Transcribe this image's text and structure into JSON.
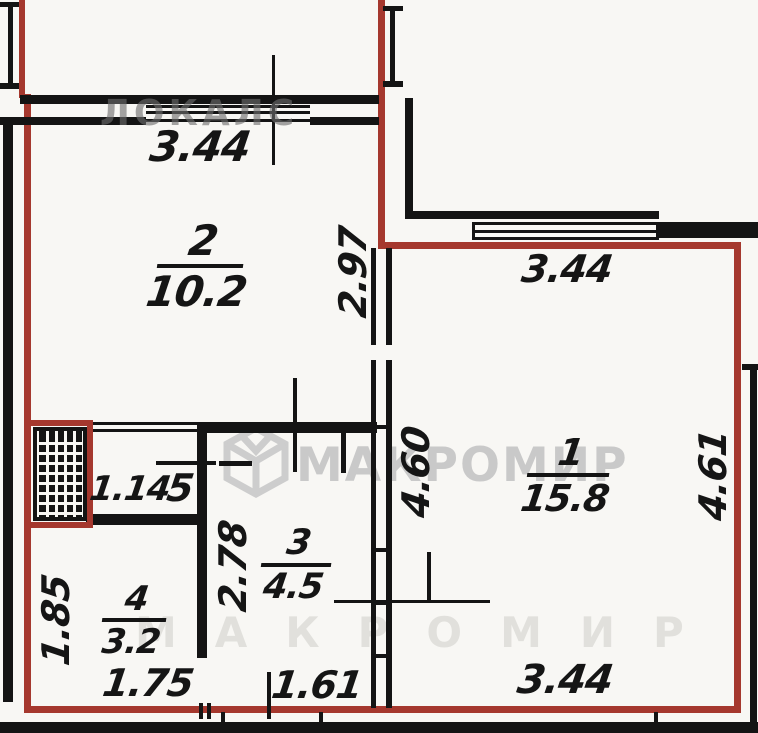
{
  "document": {
    "type": "apartment-floor-plan"
  },
  "watermarks": {
    "top": "ЛОКАЛС",
    "brand": "МАКРОМИР",
    "bottom": "МАКРОМИР",
    "logo": "makromir-cube-logo"
  },
  "rooms": {
    "room1": {
      "number": "1",
      "area": "15.8"
    },
    "room2": {
      "number": "2",
      "area": "10.2"
    },
    "room3": {
      "number": "3",
      "area": "4.5"
    },
    "room4": {
      "number": "4",
      "area": "3.2"
    },
    "room5": {
      "number": "5",
      "area": "1.14"
    }
  },
  "dimensions": {
    "top_width": "3.44",
    "room2_depth": "2.97",
    "room1_top_width": "3.44",
    "hall_depth": "4.60",
    "room1_depth": "4.61",
    "room3_depth": "2.78",
    "room4_depth": "1.85",
    "room4_width": "1.75",
    "room3_width": "1.61",
    "room1_bottom_width": "3.44"
  },
  "colors": {
    "contour_red": "#a5382e",
    "wall_black": "#141414",
    "watermark_grey": "#c9c9c9",
    "background": "#f8f7f4"
  }
}
